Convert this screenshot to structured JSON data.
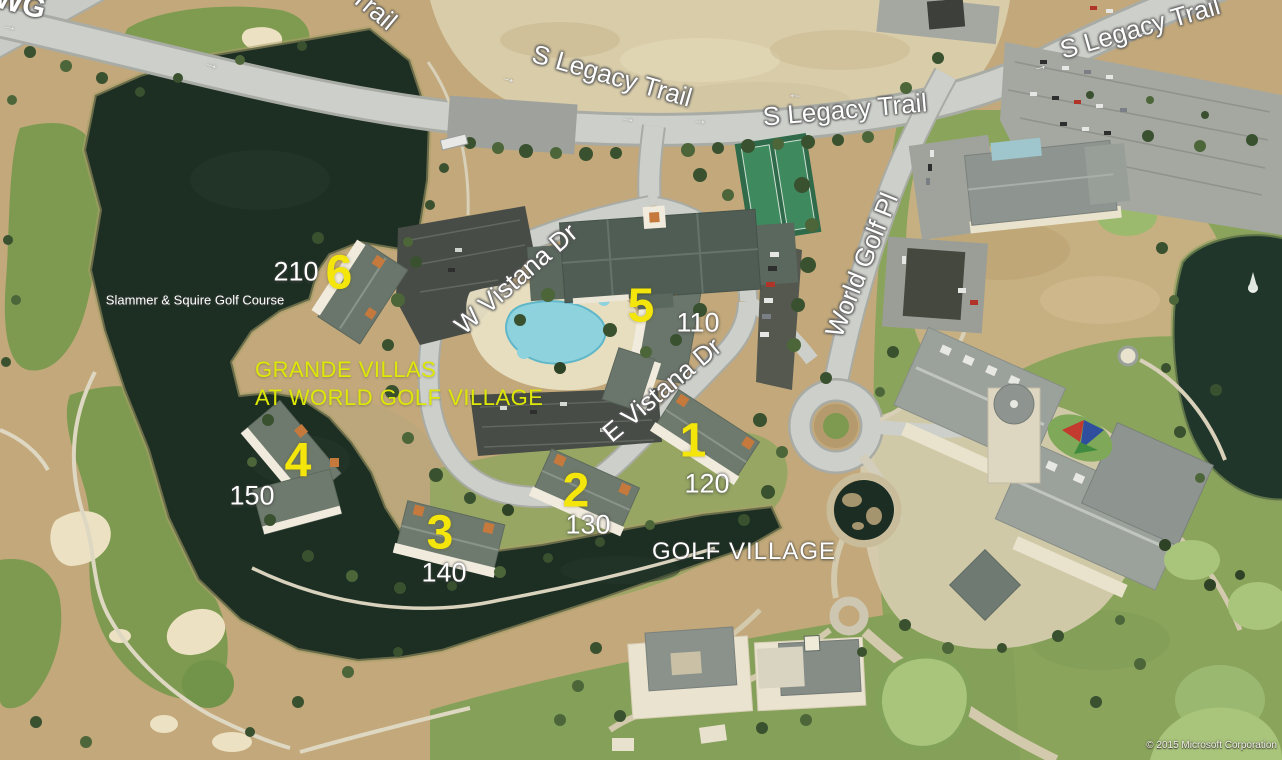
{
  "map": {
    "attribution": "© 2015 Microsoft Corporation",
    "road_labels": {
      "s_legacy_trail": "S Legacy Trail",
      "w_vistana_dr": "W Vistana Dr",
      "e_vistana_dr": "E Vistana Dr",
      "world_golf_pl": "World Golf Pl",
      "corner_fragment": "WG"
    },
    "place_labels": {
      "golf_course": "Slammer & Squire Golf Course",
      "resort_name_line1": "GRANDE VILLAS",
      "resort_name_line2": "AT WORLD GOLF VILLAGE",
      "golf_village": "GOLF VILLAGE"
    },
    "building_markers": [
      {
        "number": "1",
        "address": "120"
      },
      {
        "number": "2",
        "address": "130"
      },
      {
        "number": "3",
        "address": "140"
      },
      {
        "number": "4",
        "address": "150"
      },
      {
        "number": "5",
        "address": "110"
      },
      {
        "number": "6",
        "address": "210"
      }
    ],
    "icons": {
      "road_arrow": "→"
    },
    "colors": {
      "marker_yellow": "#f4e60a",
      "resort_label_yellow": "#dde806",
      "road_label_white": "#ffffff",
      "water_dark": "#1d2f23",
      "fairway_green": "#7d9a50",
      "ground_tan": "#c2a87a",
      "road_gray": "#cdcfca"
    }
  }
}
